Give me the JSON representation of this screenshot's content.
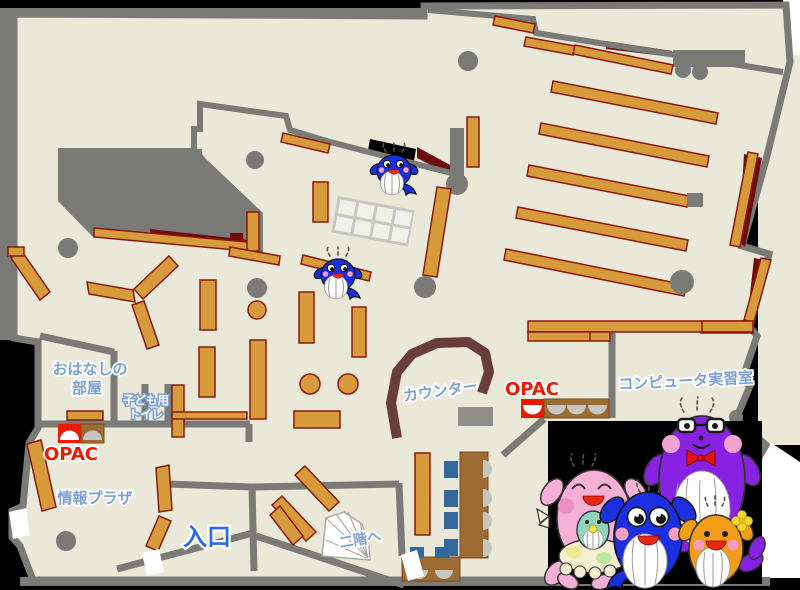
{
  "labels": {
    "storytelling_room_line1": "おはなしの",
    "storytelling_room_line2": "部屋",
    "kids_toilet_line1": "子ども用",
    "kids_toilet_line2": "トイレ",
    "opac_left": "OPAC",
    "info_plaza": "情報プラザ",
    "entrance": "入口",
    "to_second_floor": "二階へ",
    "counter": "カウンター",
    "opac_right": "OPAC",
    "computer_room": "コンピュータ実習室"
  },
  "palette": {
    "floor": "#EAE8D8",
    "wall_gray": "#7A7A77",
    "shelf_orange": "#D89B3B",
    "shelf_border": "#8B1A0E",
    "dark_red": "#6E0B0B",
    "counter_brown": "#6B3C3C",
    "desk_brown": "#9C6B33",
    "opac_desk_red": "#F21500",
    "chair_blue": "#33689B",
    "label_blue": "#7CA0D2",
    "entrance_blue": "#2A6DE5",
    "opac_label_red": "#ED1A02",
    "mascot_blue": "#1B2FE0",
    "mascot_pink": "#F6B0D5",
    "mascot_purple": "#8822E2",
    "mascot_orange": "#F49C17",
    "mascot_teal": "#8FD4BC"
  },
  "icons": {
    "map_whale_count": 2,
    "photo_mascots": [
      "pink-whale-mascot",
      "baby-teal-whale-mascot",
      "blue-whale-mascot",
      "purple-whale-mascot",
      "orange-whale-mascot"
    ]
  }
}
